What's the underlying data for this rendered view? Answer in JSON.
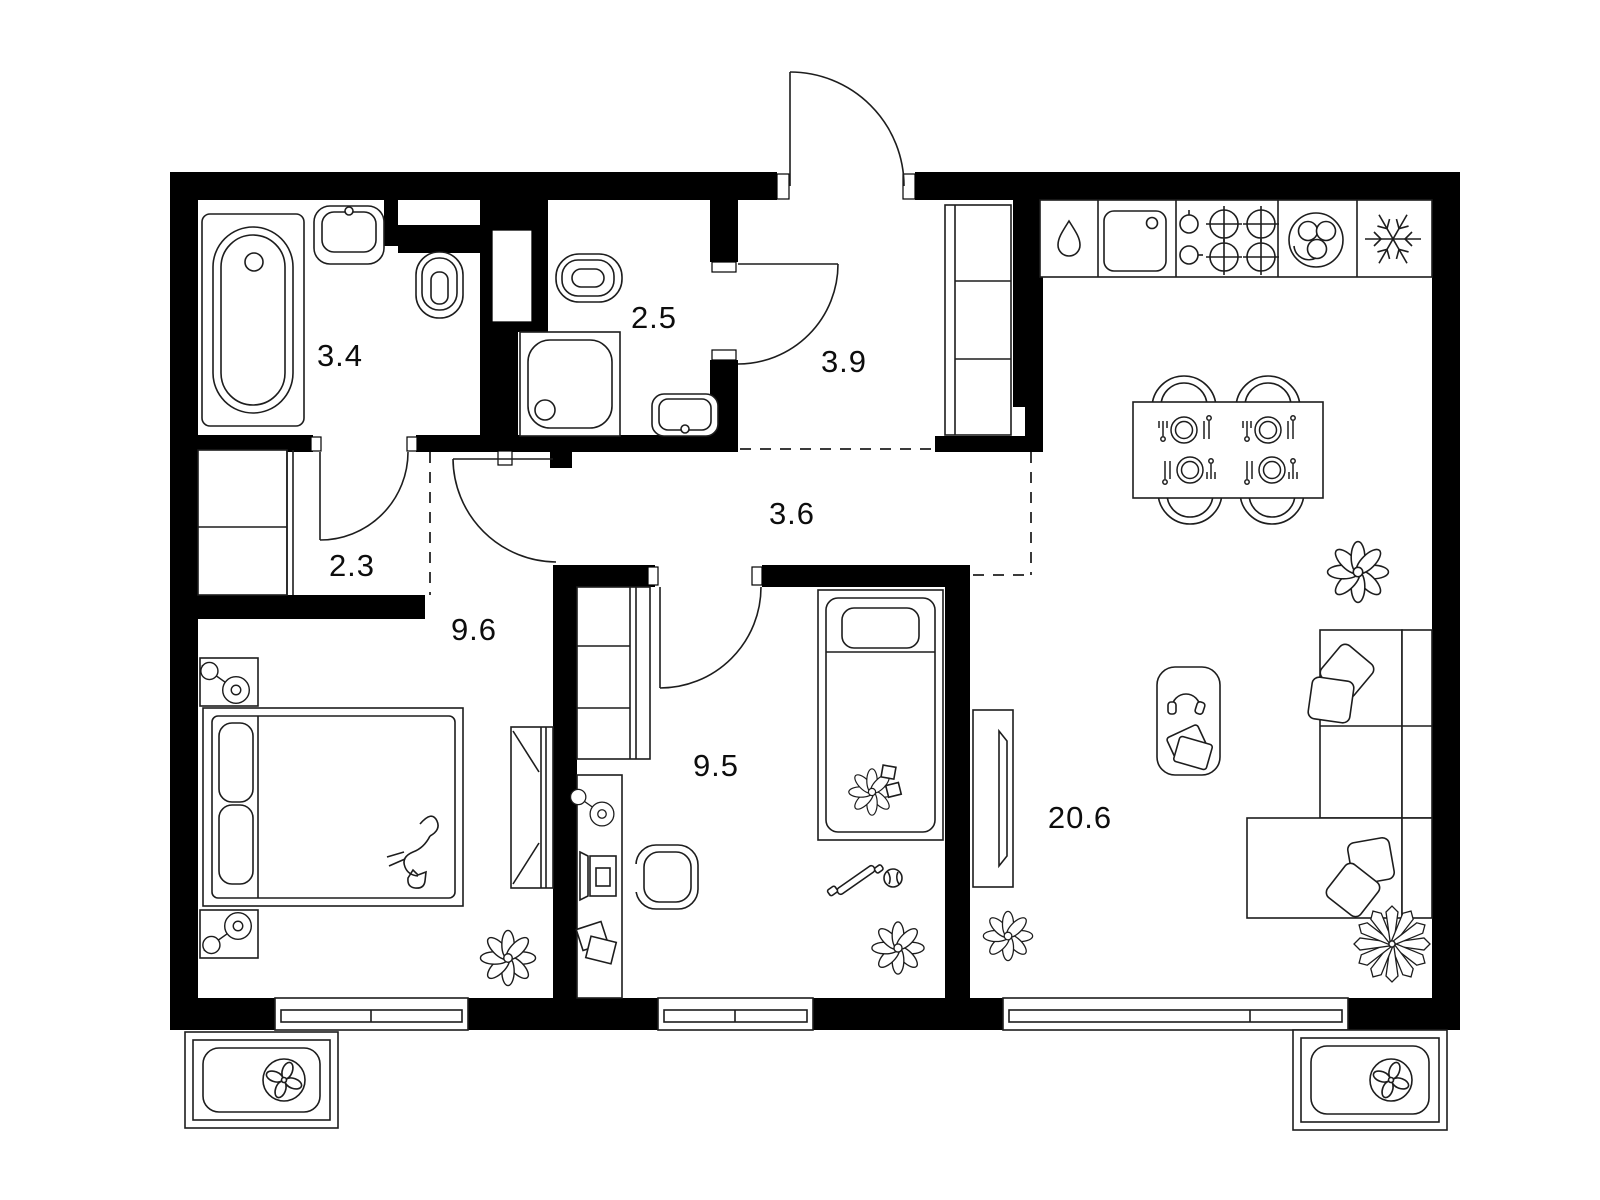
{
  "rooms": {
    "bathroom": {
      "label": "3.4"
    },
    "shower_room": {
      "label": "2.5"
    },
    "hallway": {
      "label": "3.9"
    },
    "closet": {
      "label": "2.3"
    },
    "corridor": {
      "label": "3.6"
    },
    "bedroom": {
      "label": "9.6"
    },
    "kids_room": {
      "label": "9.5"
    },
    "kitchen_living": {
      "label": "20.6"
    }
  },
  "colors": {
    "wall": "#000000",
    "line": "#1d1d1d",
    "bg": "#ffffff",
    "label": "#0d0d0d"
  }
}
